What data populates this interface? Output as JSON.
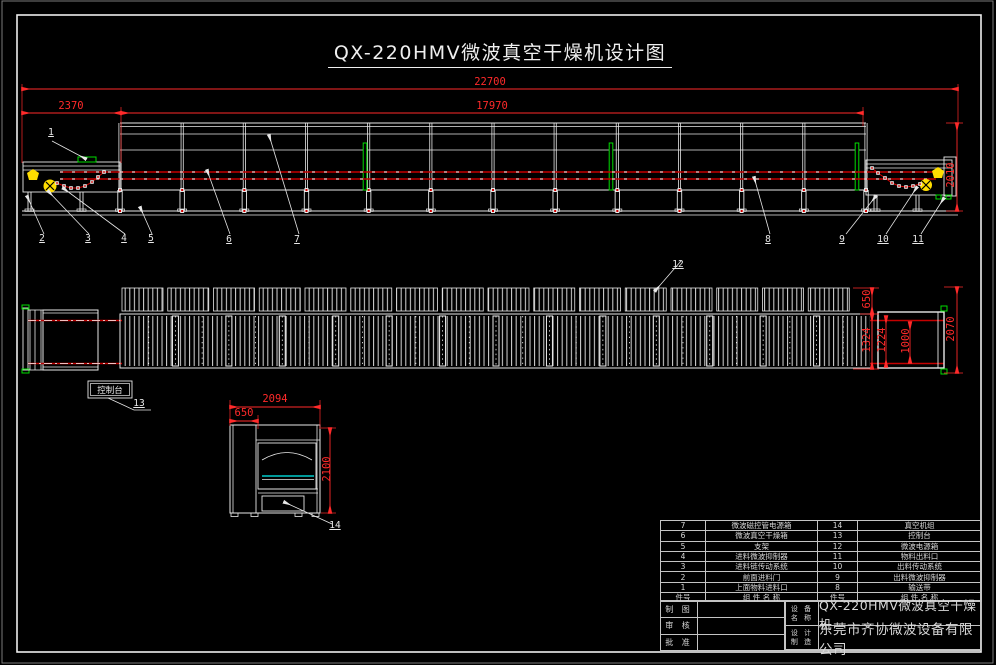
{
  "title": "QX-220HMV微波真空干燥机设计图",
  "dimensions": {
    "overall_length": "22700",
    "feed_length": "2370",
    "body_length": "17970",
    "side_height": "2010",
    "plan_top_width": "650",
    "plan_outer_width": "1324",
    "plan_chamber_width": "1224",
    "plan_belt_width": "1000",
    "plan_total_width": "2070",
    "front_width": "2094",
    "front_box_width": "650",
    "front_height": "2100"
  },
  "balloons": [
    "1",
    "2",
    "3",
    "4",
    "5",
    "6",
    "7",
    "8",
    "9",
    "10",
    "11",
    "12",
    "13",
    "14"
  ],
  "console_label": "控制台",
  "parts_table": {
    "header": [
      "件号",
      "组 件 名 称",
      "件号",
      "组 件 名 称"
    ],
    "rows": [
      [
        "7",
        "微波磁控管电源箱",
        "14",
        "真空机组"
      ],
      [
        "6",
        "微波真空干燥箱",
        "13",
        "控制台"
      ],
      [
        "5",
        "支架",
        "12",
        "微波电源箱"
      ],
      [
        "4",
        "进料微波抑制器",
        "11",
        "物料出料口"
      ],
      [
        "3",
        "进料链传动系统",
        "10",
        "出料传动系统"
      ],
      [
        "2",
        "前面进料门",
        "9",
        "出料微波抑制器"
      ],
      [
        "1",
        "上面物料进料口",
        "8",
        "输送带"
      ]
    ]
  },
  "title_block": {
    "draw_label": "制 图",
    "check_label": "审 核",
    "approve_label": "批 准",
    "device_label_1": "设 备",
    "device_label_2": "名 称",
    "design_label_1": "设 计",
    "design_label_2": "制 造",
    "device_name": "QX-220HMV微波真空干燥机",
    "company": "东莞市齐协微波设备有限公司"
  },
  "colors": {
    "background": "#000000",
    "line": "#e8e8e8",
    "dimension": "#ff2a2a",
    "highlight": "#00dd00",
    "symbol": "#ffdd00",
    "belt": "#00cccc"
  }
}
